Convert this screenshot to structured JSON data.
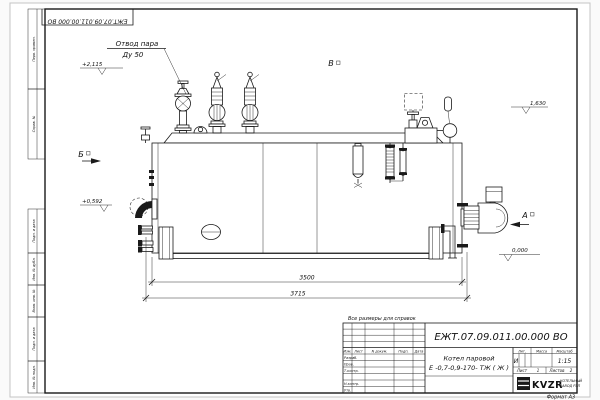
{
  "drawing": {
    "doc_number": "ЕЖТ.07.09.011.00.000  ВО",
    "title_line1": "Котел паровой",
    "title_line2": "Е -0,7-0,9-170- ТЖ ( Ж )",
    "note": "Все размеры для справок",
    "format": "Формат А3",
    "lit_header": "Лит.",
    "mass_header": "Масса",
    "scale_header": "Масштаб",
    "lit_value": "И",
    "scale_value": "1:15",
    "sheet_label": "Лист",
    "sheet_no": "1",
    "sheets_label": "Листов",
    "sheets_no": "2",
    "rows": {
      "izm": "Изм.",
      "list": "Лист",
      "ndocum": "N докум.",
      "podp": "Подп.",
      "data": "Дата",
      "razrab": "Разраб.",
      "prov": "Пров.",
      "tkontr": "Т.контр.",
      "nkontr": "Н.контр.",
      "utv": "Утв."
    },
    "logo": {
      "text": "KVZR",
      "sub1": "КОТЕЛЬНЫЙ",
      "sub2": "ЗАВОД РЭП"
    }
  },
  "labels": {
    "callout_line1": "Отвод пара",
    "callout_line2": "Ду 50",
    "view_a": "А",
    "view_b": "Б",
    "view_v": "В",
    "elev_top_left": "+2,115",
    "elev_mid_left": "+0,592",
    "elev_top_right": "1,630",
    "elev_zero": "0,000",
    "dim_inner": "3500",
    "dim_outer": "3715"
  },
  "margin_labels": [
    "Перв. примен.",
    "Справ. №",
    "Подп. и дата",
    "Инв. № дубл.",
    "Взам. инв. №",
    "Подп. и дата",
    "Инв. № подл."
  ]
}
